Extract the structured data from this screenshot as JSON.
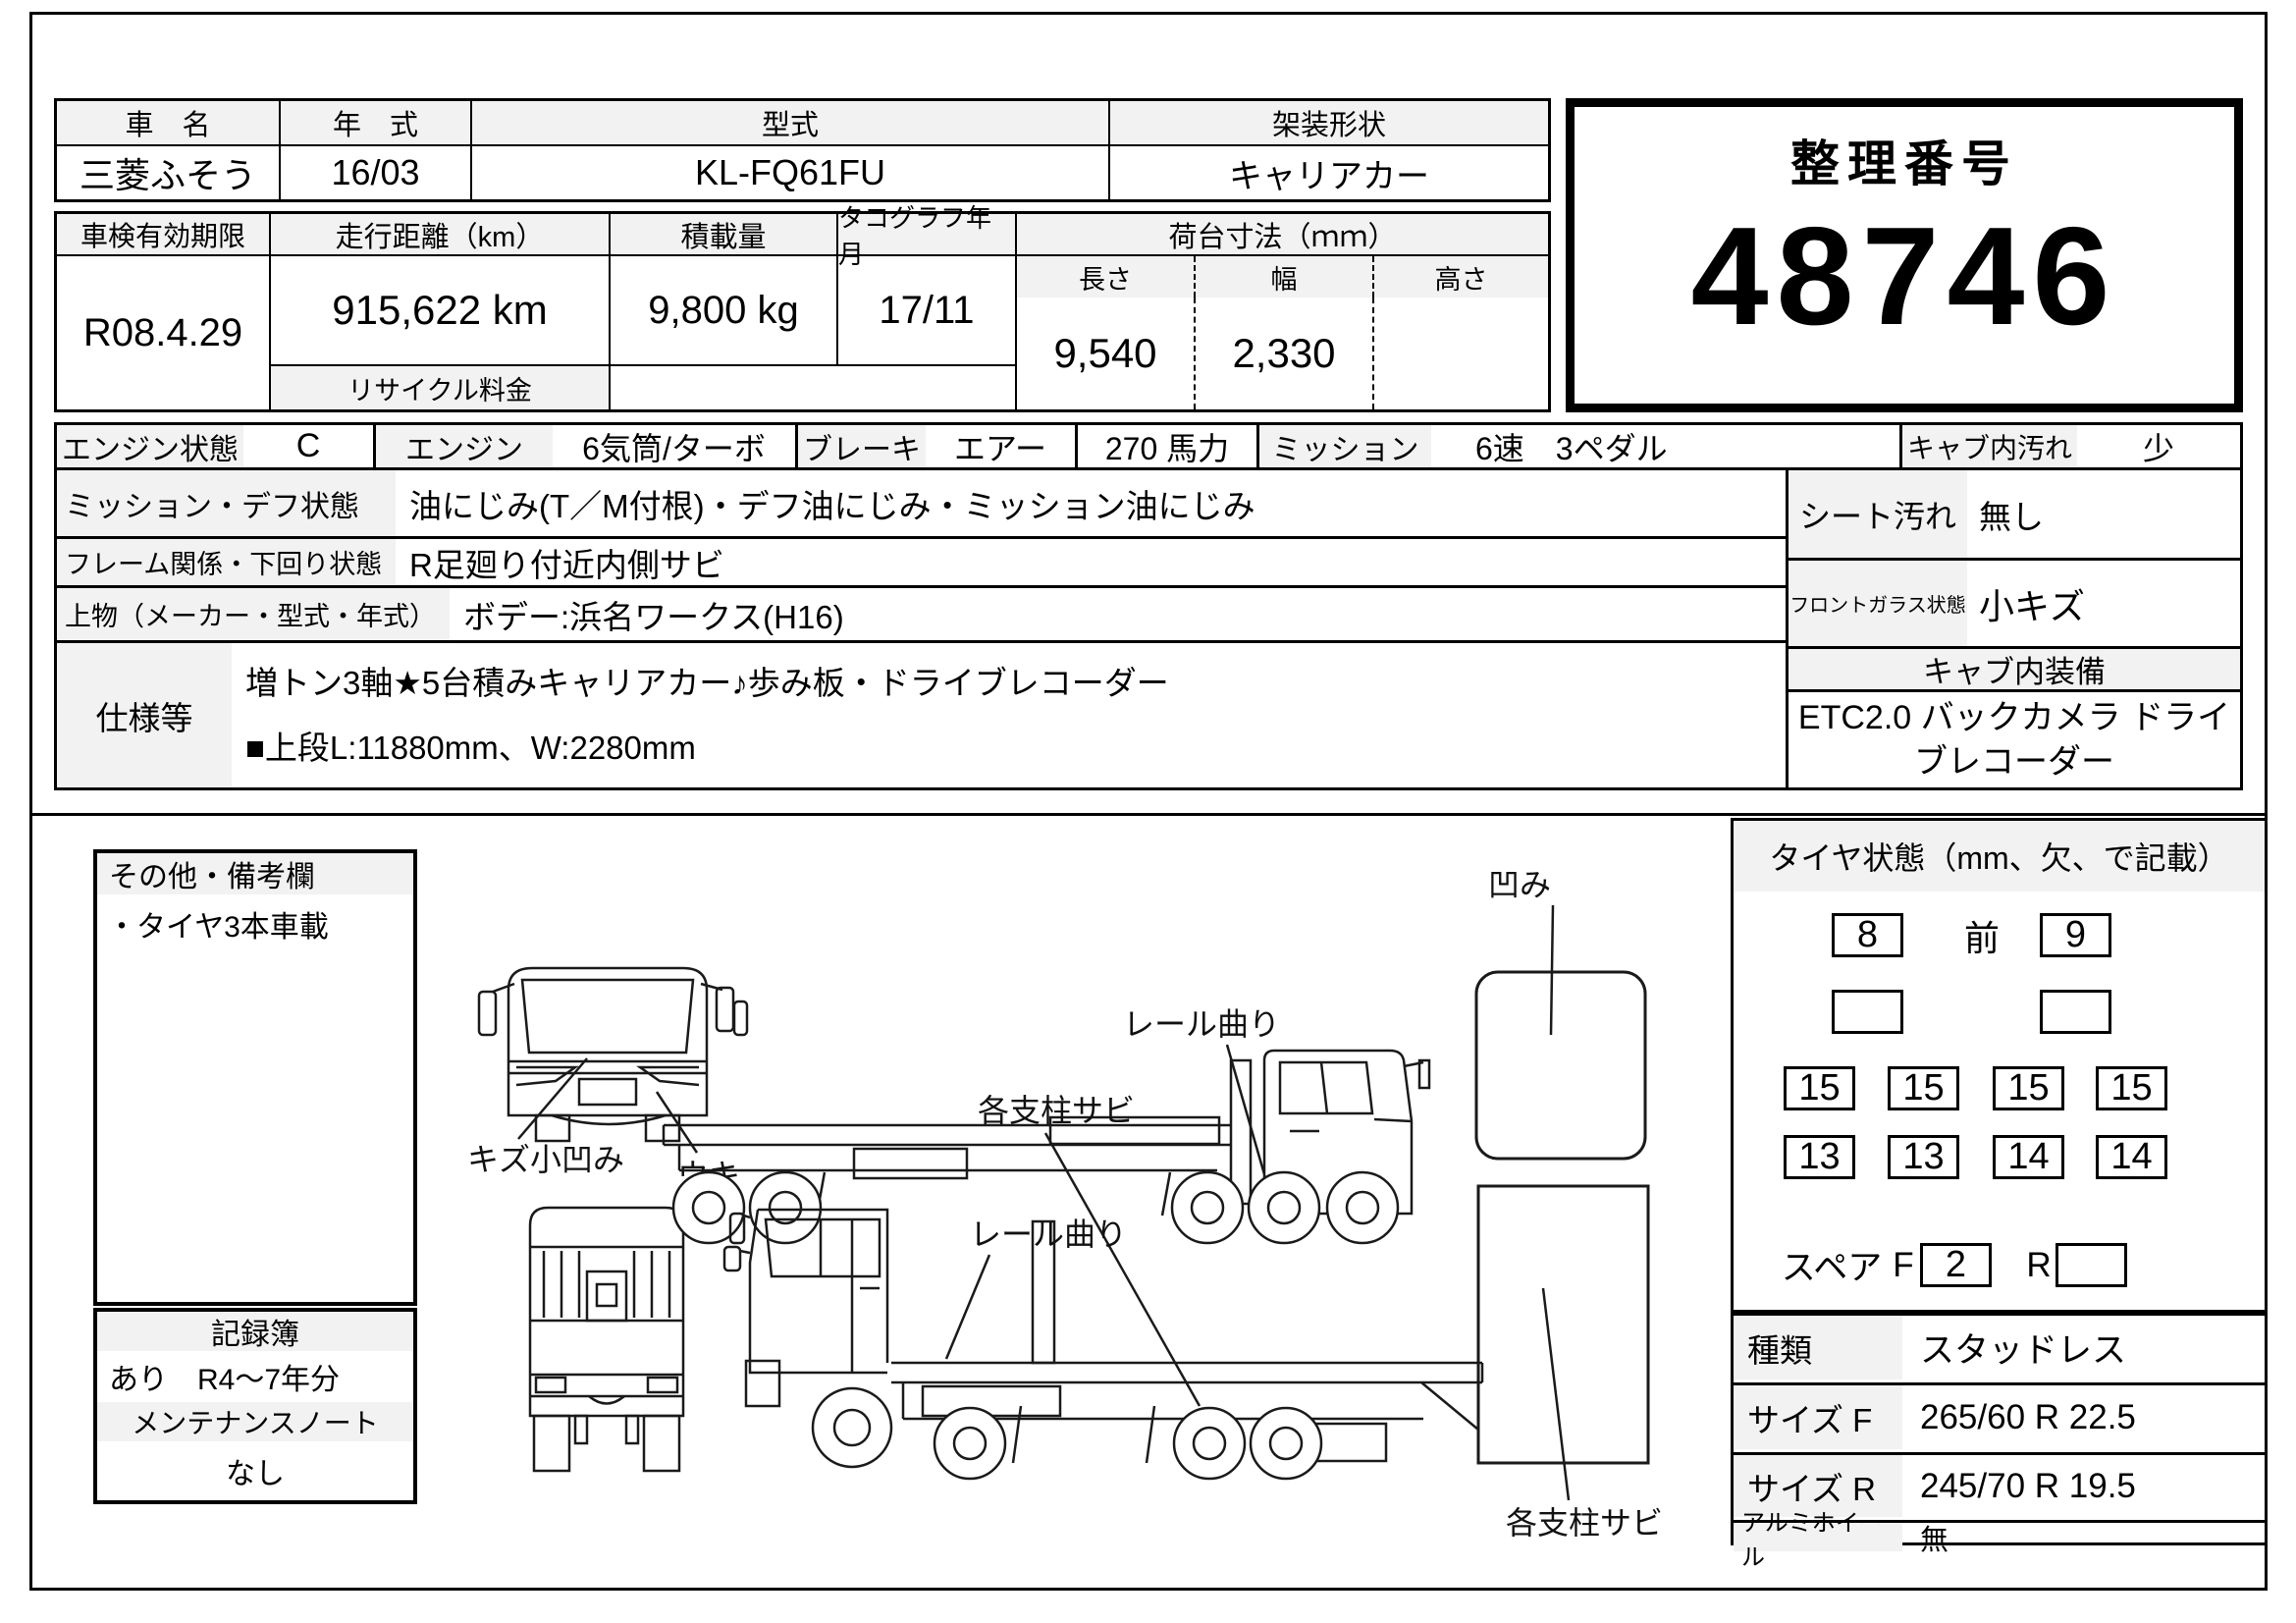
{
  "table1": {
    "h_name": "車　名",
    "h_year": "年　式",
    "h_model": "型式",
    "h_body": "架装形状",
    "v_name": "三菱ふそう",
    "v_year": "16/03",
    "v_model": "KL-FQ61FU",
    "v_body": "キャリアカー"
  },
  "seiri": {
    "label": "整理番号",
    "number": "48746"
  },
  "table2": {
    "h_shaken": "車検有効期限",
    "h_mileage": "走行距離（km）",
    "h_load": "積載量",
    "h_tacho": "タコグラフ年月",
    "h_bed": "荷台寸法（ｍｍ）",
    "h_len": "長さ",
    "h_wid": "幅",
    "h_hei": "高さ",
    "v_shaken": "R08.4.29",
    "v_mileage": "915,622 km",
    "v_load": "9,800 kg",
    "v_tacho": "17/11",
    "v_len": "9,540",
    "v_wid": "2,330",
    "v_hei": "",
    "recycle": "リサイクル料金"
  },
  "cond": {
    "engine_label": "エンジン状態",
    "engine": "C",
    "engine2_label": "エンジン",
    "engine2": "6気筒/ターボ",
    "brake_label": "ブレーキ",
    "brake": "エアー",
    "power": "270 馬力",
    "mission_label": "ミッション",
    "mission": "6速　3ペダル",
    "cab_dirt_label": "キャブ内汚れ",
    "cab_dirt": "少",
    "mission_diff_label": "ミッション・デフ状態",
    "mission_diff": "油にじみ(T／M付根)・デフ油にじみ・ミッション油にじみ",
    "frame_label": "フレーム関係・下回り状態",
    "frame": "R足廻り付近内側サビ",
    "body_label": "上物（メーカー・型式・年式）",
    "body": "ボデー:浜名ワークス(H16)",
    "spec_label": "仕様等",
    "spec1": "増トン3軸★5台積みキャリアカー♪歩み板・ドライブレコーダー",
    "spec2": "■上段L:11880mm、W:2280mm",
    "seat_label": "シート汚れ",
    "seat": "無し",
    "glass_label": "フロントガラス状態",
    "glass": "小キズ",
    "cab_equip_label": "キャブ内装備",
    "cab_equip": "ETC2.0 バックカメラ ドライブレコーダー"
  },
  "notes": {
    "title": "その他・備考欄",
    "line1": "・タイヤ3本車載"
  },
  "records": {
    "title": "記録簿",
    "value": "あり　R4～7年分",
    "maintenance_title": "メンテナンスノート",
    "maintenance_value": "なし"
  },
  "tires": {
    "title": "タイヤ状態（mm、欠、で記載）",
    "front_label": "前",
    "row1": [
      "8",
      "9"
    ],
    "row2": [
      "",
      ""
    ],
    "row3": [
      "15",
      "15",
      "15",
      "15"
    ],
    "row4": [
      "13",
      "13",
      "14",
      "14"
    ],
    "spare_label": "スペア",
    "f_label": "F",
    "spare_f": "2",
    "r_label": "R",
    "spare_r": ""
  },
  "tire_spec": {
    "type_label": "種類",
    "type": "スタッドレス",
    "size_f_label": "サイズ F",
    "size_f": "265/60 R 22.5",
    "size_r_label": "サイズ R",
    "size_r": "245/70 R 19.5",
    "alloy_label": "アルミホイール",
    "alloy": "無"
  },
  "diagram": {
    "dent": "凹み",
    "rail_bend_top": "レール曲り",
    "pillar_rust_mid": "各支柱サビ",
    "scratch_dent": "キズ小凹み",
    "uki": "ウキ",
    "rail_bend_bottom": "レール曲り",
    "pillar_rust_right": "各支柱サビ"
  }
}
